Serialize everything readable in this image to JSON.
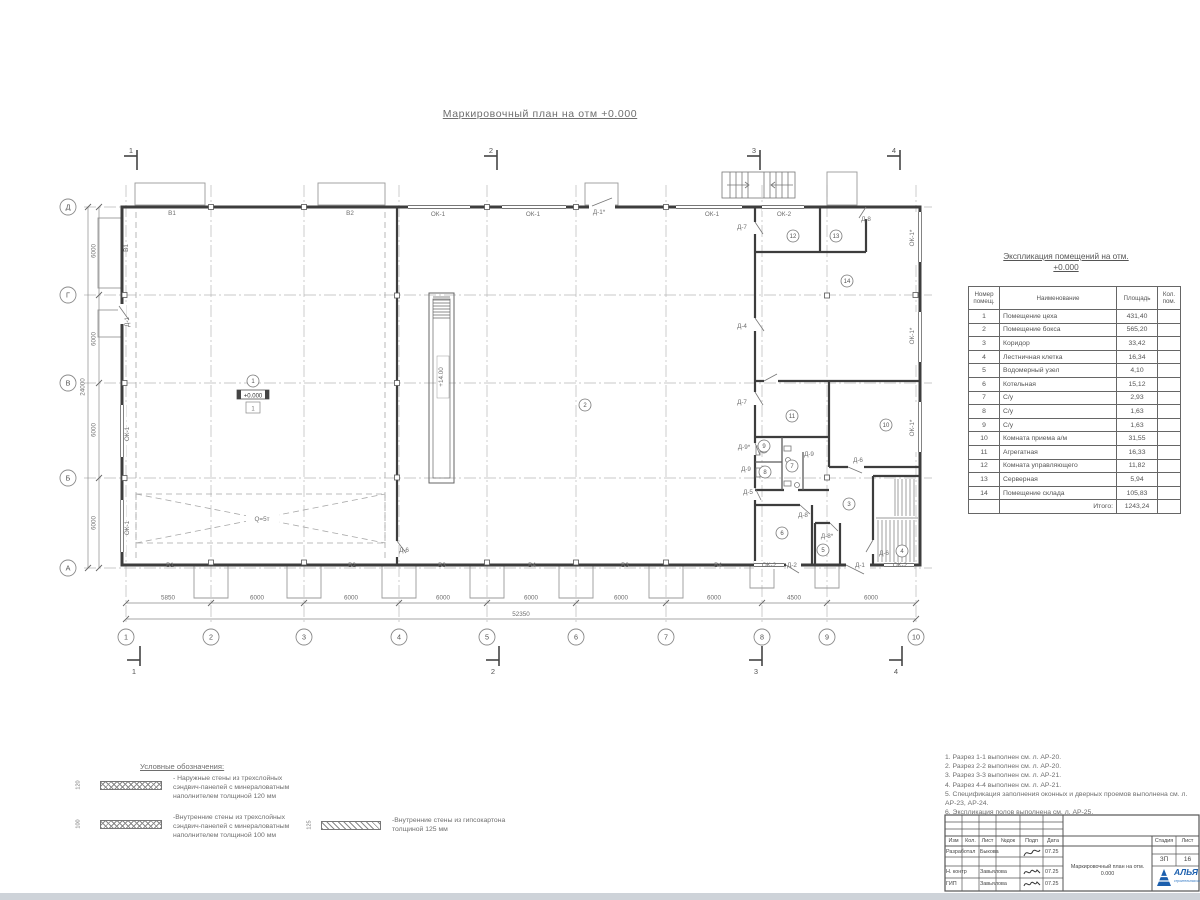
{
  "sheet": {
    "title": "Маркировочный план на отм +0.000"
  },
  "schedule": {
    "title_line1": "Экспликация помещений на отм.",
    "title_line2": "+0.000",
    "headers": {
      "num": "Номер помещ.",
      "name": "Наименование",
      "area": "Площадь",
      "qty": "Кол. пом."
    },
    "rows": [
      {
        "num": "1",
        "name": "Помещение цеха",
        "area": "431,40"
      },
      {
        "num": "2",
        "name": "Помещение бокса",
        "area": "565,20"
      },
      {
        "num": "3",
        "name": "Коридор",
        "area": "33,42"
      },
      {
        "num": "4",
        "name": "Лестничная клетка",
        "area": "16,34"
      },
      {
        "num": "5",
        "name": "Водомерный узел",
        "area": "4,10"
      },
      {
        "num": "6",
        "name": "Котельная",
        "area": "15,12"
      },
      {
        "num": "7",
        "name": "С/у",
        "area": "2,93"
      },
      {
        "num": "8",
        "name": "С/у",
        "area": "1,63"
      },
      {
        "num": "9",
        "name": "С/у",
        "area": "1,63"
      },
      {
        "num": "10",
        "name": "Комната приема а/м",
        "area": "31,55"
      },
      {
        "num": "11",
        "name": "Агрегатная",
        "area": "16,33"
      },
      {
        "num": "12",
        "name": "Комната управляющего",
        "area": "11,82"
      },
      {
        "num": "13",
        "name": "Серверная",
        "area": "5,94"
      },
      {
        "num": "14",
        "name": "Помещение склада",
        "area": "105,83"
      }
    ],
    "total_label": "Итого:",
    "total_value": "1243,24"
  },
  "legend": {
    "title": "Условные обозначения:",
    "items": [
      {
        "dim": "120",
        "hatch": "cross",
        "lines": [
          "- Наружные стены из трехслойных",
          "сэндвич-панелей с минераловатным",
          "наполнителем толщиной 120 мм"
        ]
      },
      {
        "dim": "100",
        "hatch": "cross",
        "lines": [
          "-Внутренние стены из трехслойных",
          "сэндвич-панелей с минераловатным",
          "наполнителем толщиной 100 мм"
        ]
      },
      {
        "dim": "125",
        "hatch": "diag",
        "lines": [
          "-Внутренние стены из гипсокартона",
          "толщиной 125 мм"
        ]
      }
    ]
  },
  "notes": [
    "1. Разрез 1-1 выполнен см. л. АР-20.",
    "2. Разрез 2-2 выполнен см. л. АР-20.",
    "3. Разрез 3-3 выполнен см. л. АР-21.",
    "4. Разрез 4-4 выполнен см. л. АР-21.",
    "5. Спецификация заполнения оконных и дверных проемов выполнена см. л. АР-23, АР-24.",
    "6. Экспликация полов выполнена см. л. АР-25."
  ],
  "titleblock": {
    "cols": [
      "Изм",
      "Кол.",
      "Лист",
      "№док",
      "Подп",
      "Дата"
    ],
    "rows": [
      {
        "role": "Разработал",
        "name": "Быкова",
        "date": "07.25"
      },
      {
        "role": "Н. контр",
        "name": "Завьялова",
        "date": "07.25"
      },
      {
        "role": "ГИП",
        "name": "Завьялова",
        "date": "07.25"
      }
    ],
    "doc_title": "Маркировочный план на отм. 0.000",
    "stage_label": "Стадия",
    "sheet_label": "Лист",
    "stage": "ЗП",
    "sheet_no": "16",
    "company": "АЛЬЯ",
    "company_sub": "строительная компания",
    "logo_color": "#1b5fae"
  },
  "plan": {
    "level_mark": "+0.000",
    "floor_mark": "1",
    "grid_cols": [
      {
        "label": "1",
        "x": 126
      },
      {
        "label": "2",
        "x": 211
      },
      {
        "label": "3",
        "x": 304
      },
      {
        "label": "4",
        "x": 399
      },
      {
        "label": "5",
        "x": 487
      },
      {
        "label": "6",
        "x": 576
      },
      {
        "label": "7",
        "x": 666
      },
      {
        "label": "8",
        "x": 762
      },
      {
        "label": "9",
        "x": 827
      },
      {
        "label": "10",
        "x": 916
      }
    ],
    "grid_rows": [
      {
        "label": "Д",
        "y": 207
      },
      {
        "label": "Г",
        "y": 295
      },
      {
        "label": "В",
        "y": 383
      },
      {
        "label": "Б",
        "y": 478
      },
      {
        "label": "А",
        "y": 568
      }
    ],
    "dims_bottom": [
      {
        "text": "5850",
        "x": 168
      },
      {
        "text": "6000",
        "x": 257
      },
      {
        "text": "6000",
        "x": 351
      },
      {
        "text": "6000",
        "x": 443
      },
      {
        "text": "6000",
        "x": 531
      },
      {
        "text": "6000",
        "x": 621
      },
      {
        "text": "6000",
        "x": 714
      },
      {
        "text": "4500",
        "x": 794
      },
      {
        "text": "6000",
        "x": 871
      }
    ],
    "total_bottom": "52350",
    "dims_left": [
      {
        "text": "6000",
        "y": 251
      },
      {
        "text": "6000",
        "y": 339
      },
      {
        "text": "6000",
        "y": 430
      },
      {
        "text": "6000",
        "y": 523
      }
    ],
    "total_left": "24000",
    "sections_top": [
      {
        "label": "1",
        "x": 137
      },
      {
        "label": "2",
        "x": 497
      },
      {
        "label": "3",
        "x": 760
      },
      {
        "label": "4",
        "x": 900
      }
    ],
    "sections_bottom": [
      {
        "label": "1",
        "x": 140
      },
      {
        "label": "2",
        "x": 499
      },
      {
        "label": "3",
        "x": 762
      },
      {
        "label": "4",
        "x": 902
      }
    ],
    "rooms": [
      {
        "n": "1",
        "x": 253,
        "y": 381
      },
      {
        "n": "2",
        "x": 585,
        "y": 405
      },
      {
        "n": "3",
        "x": 849,
        "y": 504
      },
      {
        "n": "4",
        "x": 902,
        "y": 551
      },
      {
        "n": "5",
        "x": 823,
        "y": 550
      },
      {
        "n": "6",
        "x": 782,
        "y": 533
      },
      {
        "n": "7",
        "x": 792,
        "y": 466
      },
      {
        "n": "8",
        "x": 765,
        "y": 472
      },
      {
        "n": "9",
        "x": 764,
        "y": 446
      },
      {
        "n": "10",
        "x": 886,
        "y": 425
      },
      {
        "n": "11",
        "x": 792,
        "y": 416
      },
      {
        "n": "12",
        "x": 793,
        "y": 236
      },
      {
        "n": "13",
        "x": 836,
        "y": 236
      },
      {
        "n": "14",
        "x": 847,
        "y": 281
      }
    ],
    "labels": [
      {
        "t": "В1",
        "x": 172,
        "y": 215
      },
      {
        "t": "В2",
        "x": 350,
        "y": 215
      },
      {
        "t": "ОК-1",
        "x": 438,
        "y": 216
      },
      {
        "t": "ОК-1",
        "x": 533,
        "y": 216
      },
      {
        "t": "Д-1*",
        "x": 599,
        "y": 214
      },
      {
        "t": "ОК-1",
        "x": 712,
        "y": 216
      },
      {
        "t": "ОК-2",
        "x": 784,
        "y": 216
      },
      {
        "t": "Д-8",
        "x": 866,
        "y": 221
      },
      {
        "t": "Д-7",
        "x": 742,
        "y": 229
      },
      {
        "t": "Д-4",
        "x": 742,
        "y": 328
      },
      {
        "t": "Д-7",
        "x": 742,
        "y": 404
      },
      {
        "t": "Д-9*",
        "x": 744,
        "y": 449
      },
      {
        "t": "Д-9",
        "x": 746,
        "y": 471
      },
      {
        "t": "Д-9",
        "x": 809,
        "y": 456
      },
      {
        "t": "Д-6",
        "x": 858,
        "y": 462
      },
      {
        "t": "Д-5",
        "x": 748,
        "y": 494
      },
      {
        "t": "Д-8",
        "x": 803,
        "y": 517
      },
      {
        "t": "Д-8*",
        "x": 827,
        "y": 538
      },
      {
        "t": "Д-6",
        "x": 884,
        "y": 555
      },
      {
        "t": "ОК-2",
        "x": 769,
        "y": 567
      },
      {
        "t": "Д-2",
        "x": 792,
        "y": 567
      },
      {
        "t": "Д-1",
        "x": 860,
        "y": 567
      },
      {
        "t": "ОК-2",
        "x": 900,
        "y": 567
      },
      {
        "t": "В1",
        "x": 170,
        "y": 567
      },
      {
        "t": "В2",
        "x": 352,
        "y": 567
      },
      {
        "t": "В3",
        "x": 442,
        "y": 567
      },
      {
        "t": "В4",
        "x": 532,
        "y": 567
      },
      {
        "t": "В3",
        "x": 625,
        "y": 567
      },
      {
        "t": "В4",
        "x": 718,
        "y": 567
      },
      {
        "t": "Д-6",
        "x": 404,
        "y": 552
      },
      {
        "t": "Q=5т",
        "x": 262,
        "y": 521
      },
      {
        "t": "В1",
        "x": 128,
        "y": 248,
        "r": -90
      },
      {
        "t": "Д-1",
        "x": 129,
        "y": 322,
        "r": -90
      },
      {
        "t": "ОК-1",
        "x": 129,
        "y": 434,
        "r": -90
      },
      {
        "t": "ОК-1",
        "x": 129,
        "y": 528,
        "r": -90
      },
      {
        "t": "ОК-1*",
        "x": 914,
        "y": 238,
        "r": -90
      },
      {
        "t": "ОК-1*",
        "x": 914,
        "y": 336,
        "r": -90
      },
      {
        "t": "ОК-1*",
        "x": 914,
        "y": 428,
        "r": -90
      },
      {
        "t": "+14.00",
        "x": 443,
        "y": 377,
        "r": -90
      }
    ]
  }
}
